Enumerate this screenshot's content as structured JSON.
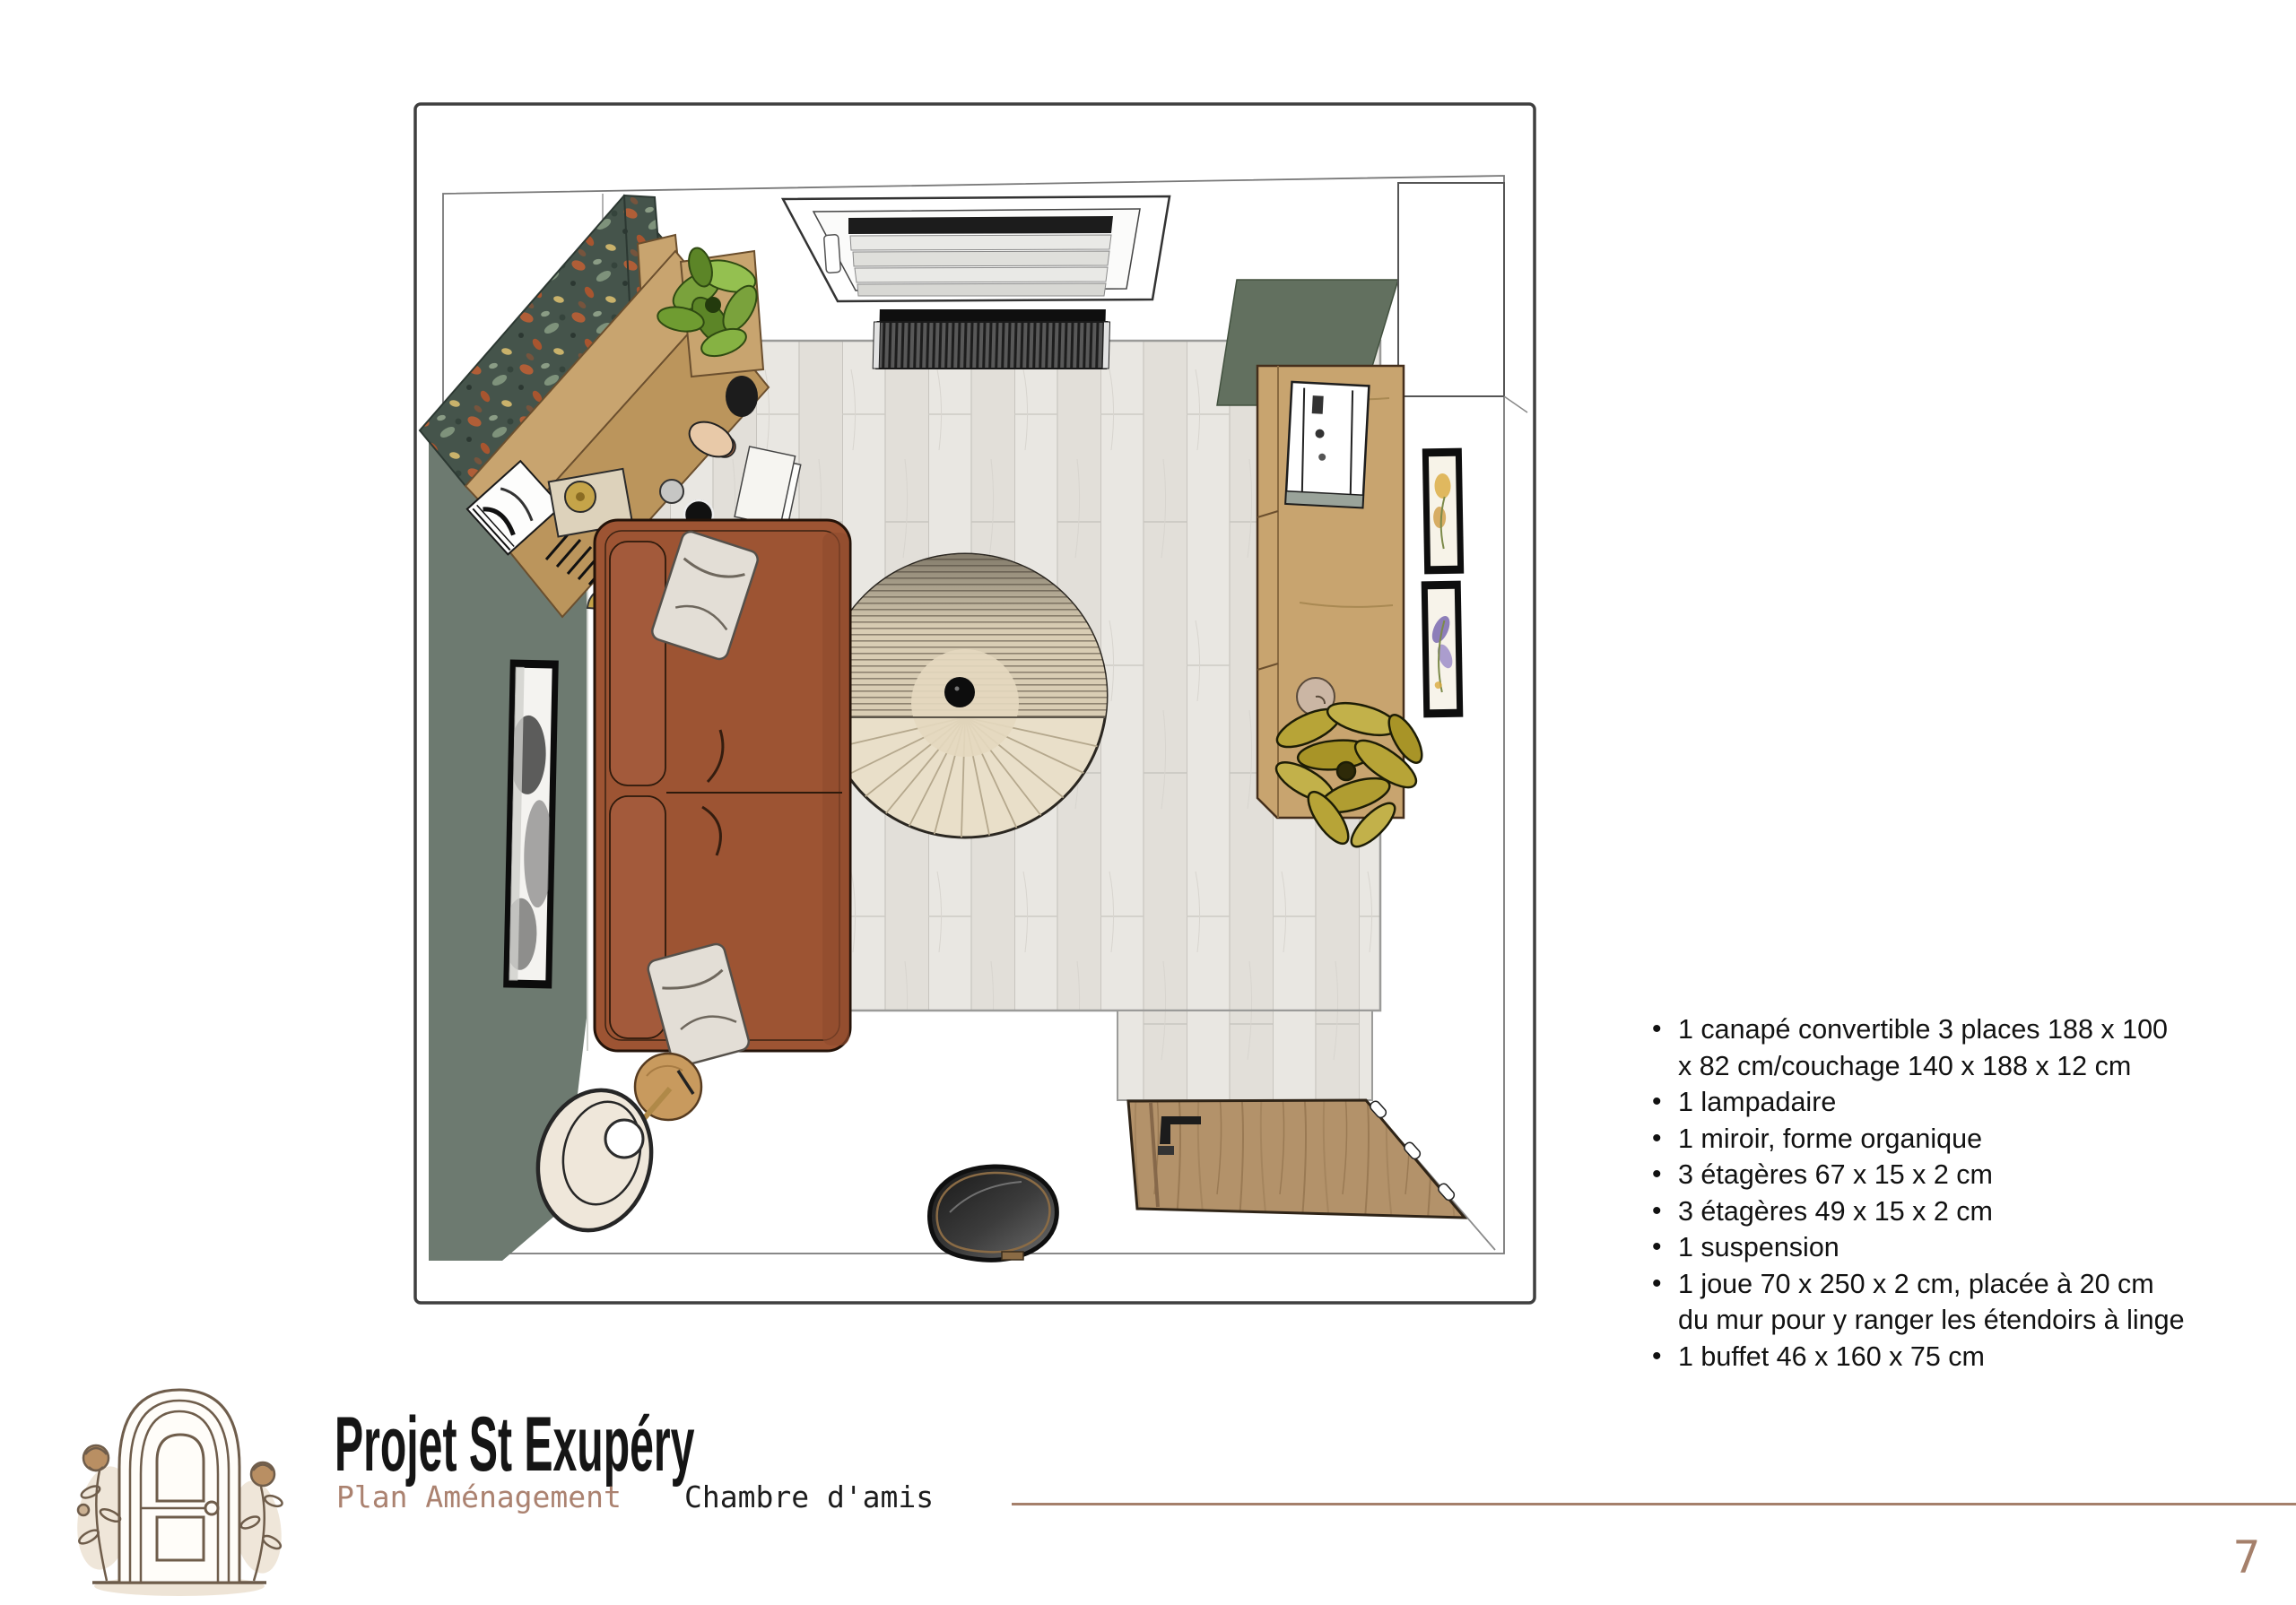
{
  "furniture_list": {
    "items": [
      "1 canapé convertible 3 places 188 x 100 x 82 cm/couchage 140 x 188 x 12 cm",
      "1 lampadaire",
      "1 miroir, forme organique",
      "3 étagères 67 x 15 x 2 cm",
      "3 étagères 49 x 15 x 2 cm",
      "1 suspension",
      "1 joue 70 x 250 x 2 cm, placée à 20 cm du mur pour y ranger les étendoirs à linge",
      "1 buffet 46 x 160 x 75 cm"
    ]
  },
  "footer": {
    "title": "Projet St Exupéry",
    "subtitle_left": "Plan Aménagement",
    "subtitle_right": "Chambre d'amis",
    "page_number": "7"
  },
  "plan": {
    "type": "top-down furniture layout render",
    "room": "Chambre d'amis",
    "elements": [
      "corner-desk-with-floral-wallpaper",
      "window-with-blinds",
      "radiator",
      "green-accent-walls",
      "convertible-sofa",
      "round-suspension-light",
      "wall-picture",
      "floor-lamp",
      "side-table",
      "organic-mirror",
      "entry-door-open",
      "buffet",
      "plant",
      "two-botanical-frames",
      "wood-plank-floor"
    ]
  },
  "colors": {
    "accent_brown": "#a5806b",
    "subtitle_brown": "#ab8270",
    "wall_green": "#6d7a70",
    "sofa_rust": "#9d5433",
    "wood": "#c8a46f",
    "floor": "#e9e7e2"
  }
}
